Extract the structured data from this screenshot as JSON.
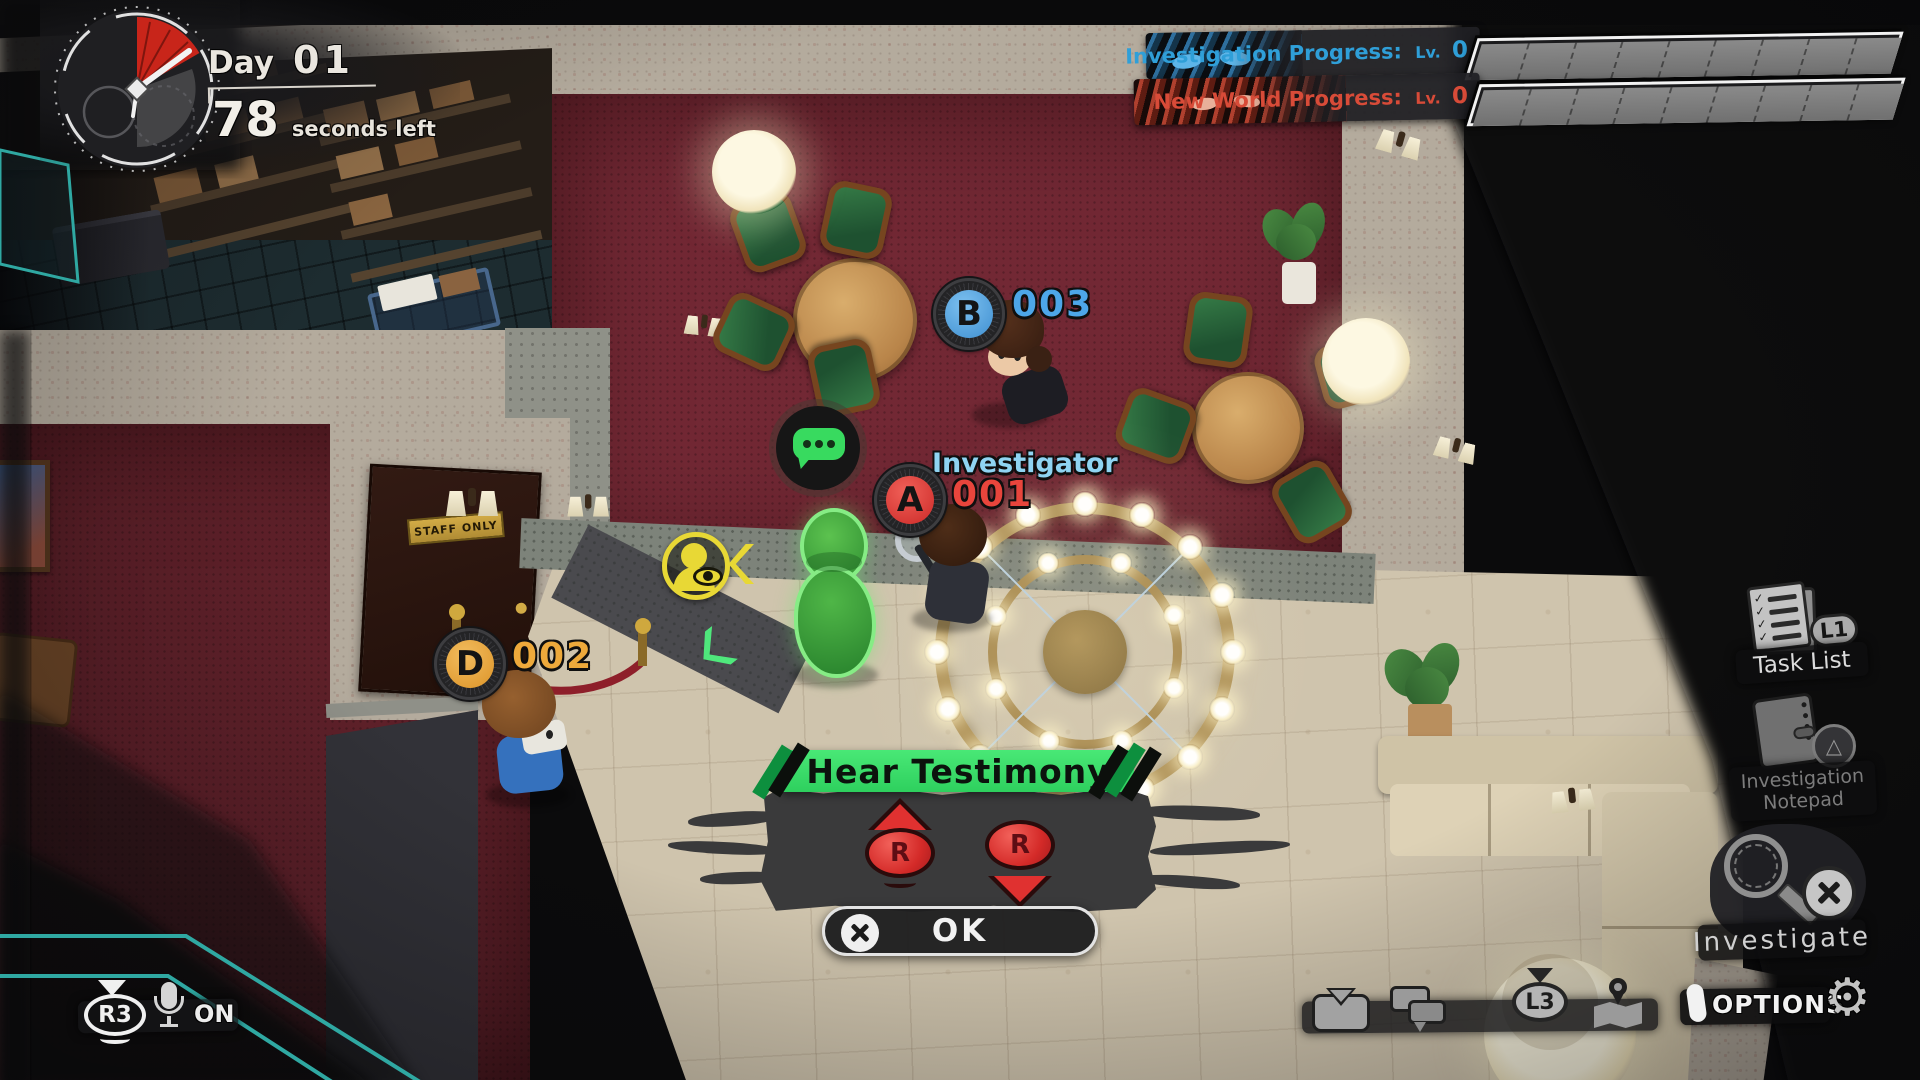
{
  "colors": {
    "investigation_accent": "#2f9fd8",
    "new_world_accent": "#d84b38",
    "banner_green": "#3fe16b",
    "badge_b": "#4da6e8",
    "badge_a": "#e23c38",
    "badge_d": "#eda93b",
    "eye_yellow": "#e8d835",
    "hud_teal": "#2fa8a2"
  },
  "timer": {
    "day_label": "Day",
    "day_number": "01",
    "seconds_value": "78",
    "seconds_label": "seconds left"
  },
  "progress": [
    {
      "label": "Investigation Progress:",
      "level_label": "Lv.",
      "level_value": "0"
    },
    {
      "label": "New World Progress:",
      "level_label": "Lv.",
      "level_value": "0"
    }
  ],
  "characters": [
    {
      "badge_letter": "B",
      "id_number": "003"
    },
    {
      "badge_letter": "A",
      "id_number": "001",
      "role_label": "Investigator"
    },
    {
      "badge_letter": "D",
      "id_number": "002"
    }
  ],
  "scene": {
    "door_sign": "STAFF ONLY"
  },
  "action_panel": {
    "title": "Hear Testimony",
    "stick_label": "R",
    "confirm_label": "OK"
  },
  "right_menu": {
    "task_list": {
      "label": "Task List",
      "button_label": "L1",
      "check_glyph": "✓"
    },
    "notepad": {
      "label_line1": "Investigation",
      "label_line2": "Notepad",
      "button_glyph": "△"
    },
    "investigate": {
      "label": "Investigate"
    }
  },
  "voice_chat": {
    "button_label": "R3",
    "status_label": "ON"
  },
  "bottom_bar": {
    "l3_label": "L3",
    "options_label": "OPTIONS",
    "gear_glyph": "⚙"
  }
}
